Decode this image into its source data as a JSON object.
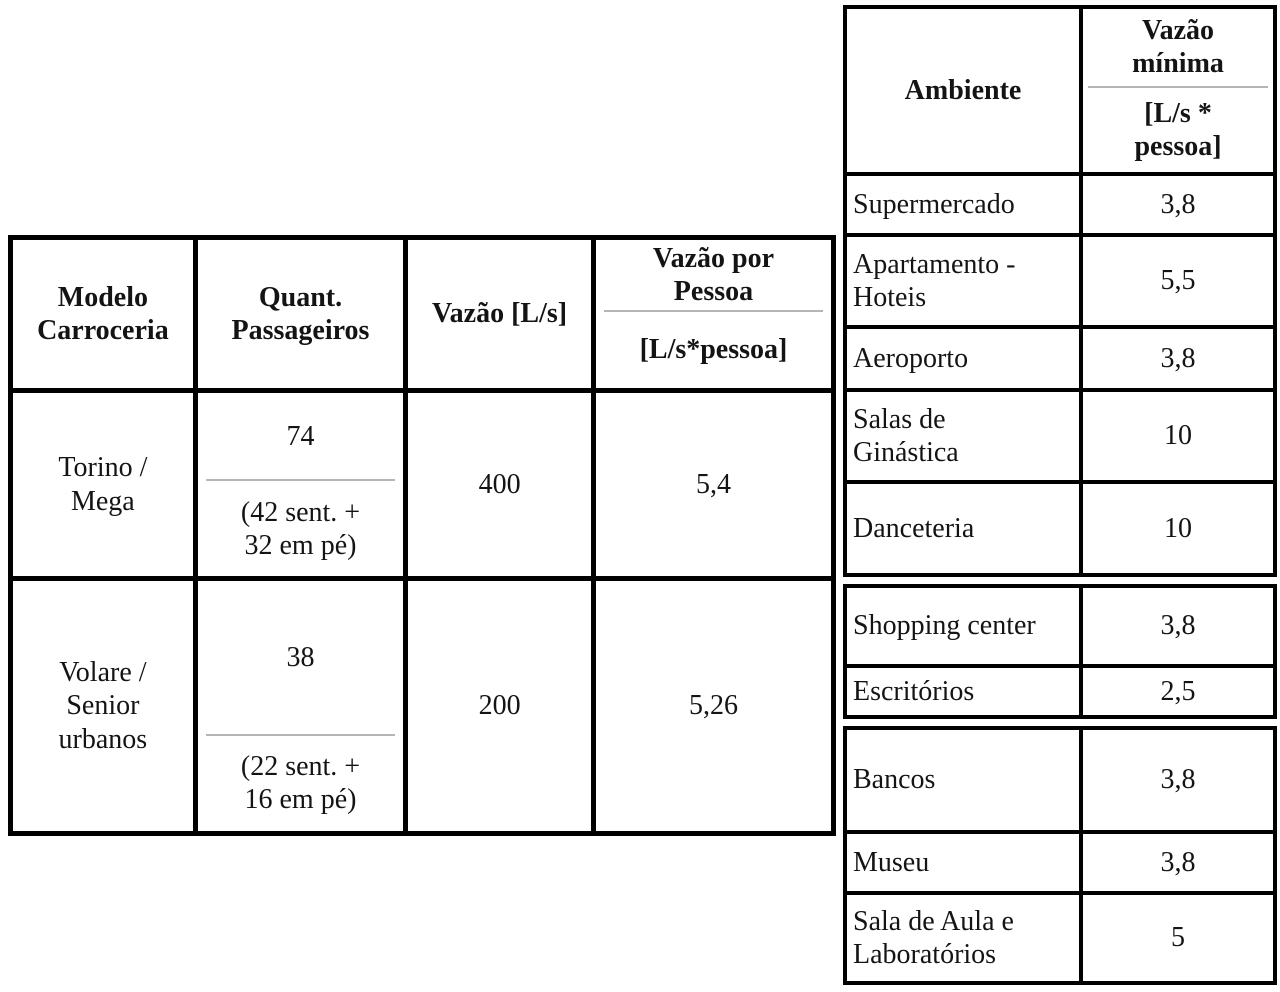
{
  "colors": {
    "border": "#000000",
    "divider": "#b5b5b5",
    "text": "#141414",
    "background": "#ffffff"
  },
  "left_table": {
    "headers": {
      "modelo": "Modelo\nCarroceria",
      "passageiros": "Quant.\nPassageiros",
      "vazao": "Vazão [L/s]",
      "vazao_por_pessoa_top": "Vazão por\nPessoa",
      "vazao_por_pessoa_unit": "[L/s*pessoa]"
    },
    "rows": [
      {
        "modelo": "Torino /\nMega",
        "passageiros_total": "74",
        "passageiros_detalhe": "(42 sent. +\n32 em pé)",
        "vazao": "400",
        "vazao_por_pessoa": "5,4"
      },
      {
        "modelo": "Volare /\nSenior\nurbanos",
        "passageiros_total": "38",
        "passageiros_detalhe": "(22 sent. +\n16 em pé)",
        "vazao": "200",
        "vazao_por_pessoa": "5,26"
      }
    ]
  },
  "right_table": {
    "headers": {
      "ambiente": "Ambiente",
      "vazao_minima_top": "Vazão\nmínima",
      "vazao_minima_unit": "[L/s *\npessoa]"
    },
    "rows": [
      {
        "ambiente": "Supermercado",
        "vazao_minima": "3,8"
      },
      {
        "ambiente": "Apartamento -\nHoteis",
        "vazao_minima": "5,5"
      },
      {
        "ambiente": "Aeroporto",
        "vazao_minima": "3,8"
      },
      {
        "ambiente": "Salas de\nGinástica",
        "vazao_minima": "10"
      },
      {
        "ambiente": "Danceteria",
        "vazao_minima": "10"
      },
      {
        "ambiente": "Shopping center",
        "vazao_minima": "3,8"
      },
      {
        "ambiente": "Escritórios",
        "vazao_minima": "2,5"
      },
      {
        "ambiente": "Bancos",
        "vazao_minima": "3,8"
      },
      {
        "ambiente": "Museu",
        "vazao_minima": "3,8"
      },
      {
        "ambiente": "Sala de Aula e\nLaboratórios",
        "vazao_minima": "5"
      }
    ]
  }
}
